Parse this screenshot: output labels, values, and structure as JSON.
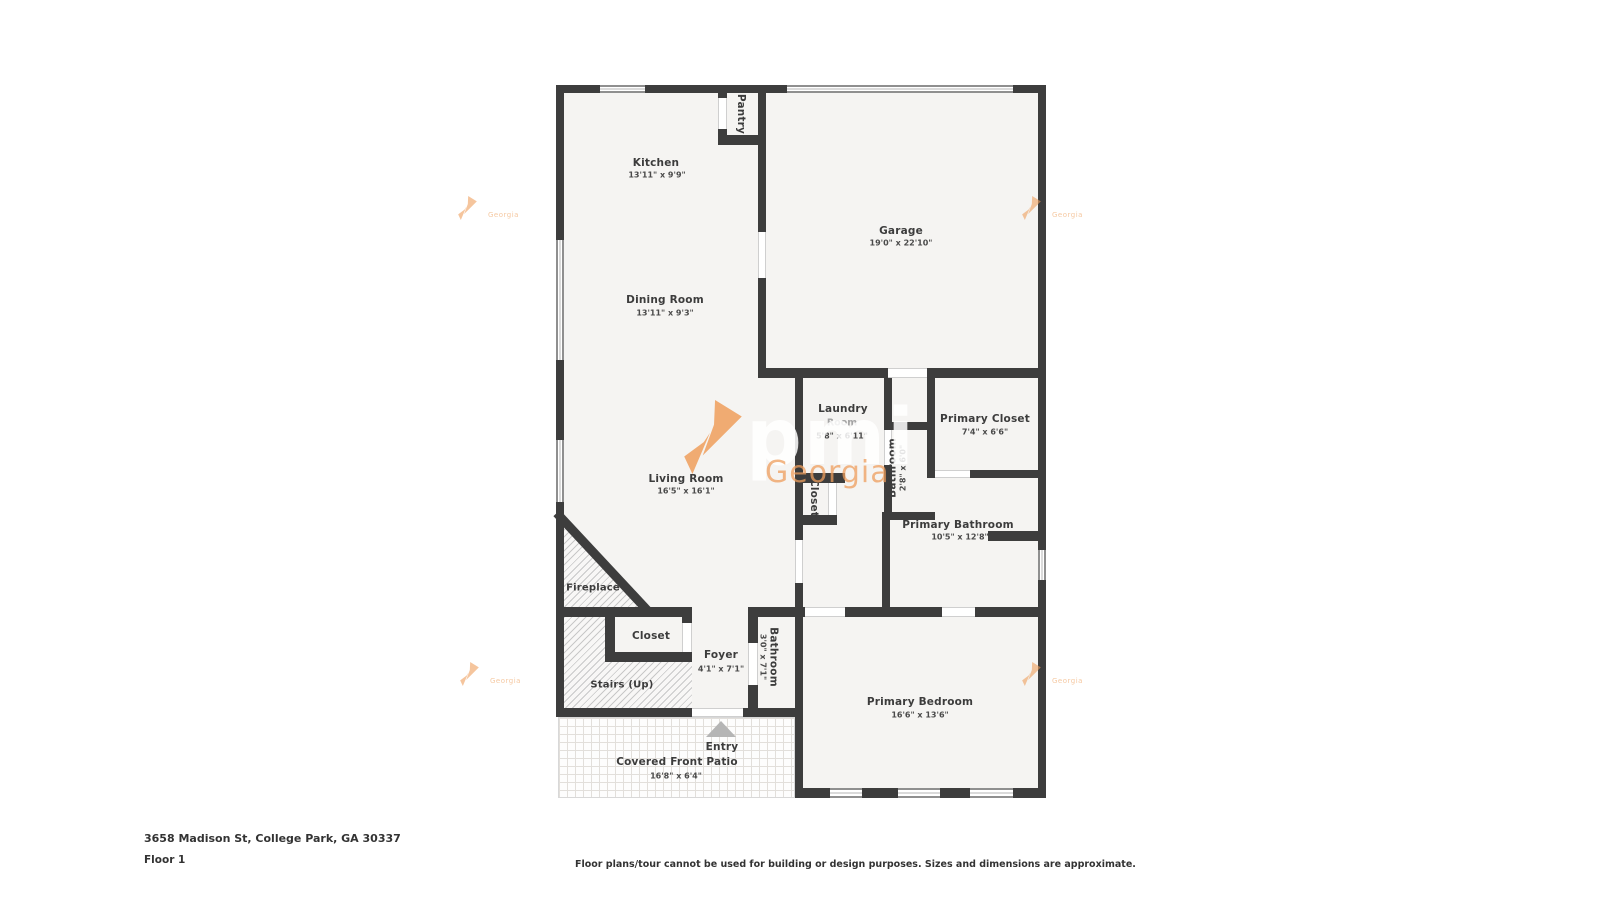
{
  "palette": {
    "wall": "#3d3d3d",
    "floor": "#f5f4f2",
    "accent_orange": "#ee9e5c",
    "label": "#3c3c3c",
    "muted_label": "#a3a3a3",
    "arrow_gray": "#b5b5b5"
  },
  "rooms": {
    "kitchen": {
      "label": "Kitchen",
      "dims": "13'11\" x 9'9\""
    },
    "pantry": {
      "label": "Pantry"
    },
    "garage": {
      "label": "Garage",
      "dims": "19'0\" x 22'10\""
    },
    "dining": {
      "label": "Dining Room",
      "dims": "13'11\" x 9'3\""
    },
    "living": {
      "label": "Living Room",
      "dims": "16'5\" x 16'1\""
    },
    "laundry": {
      "label": "Laundry",
      "label2": "Room",
      "dims": "5'8\" x 6'11\""
    },
    "bathroom_small": {
      "label": "Bathroom",
      "dims": "2'8\" x 6'0\""
    },
    "primary_closet": {
      "label": "Primary Closet",
      "dims": "7'4\" x 6'6\""
    },
    "hall_closet": {
      "label": "Closet"
    },
    "primary_bathroom": {
      "label": "Primary Bathroom",
      "dims": "10'5\" x 12'8\""
    },
    "fireplace": {
      "label": "Fireplace"
    },
    "foyer_closet": {
      "label": "Closet"
    },
    "foyer": {
      "label": "Foyer",
      "dims": "4'1\" x 7'1\""
    },
    "foyer_bathroom": {
      "label": "Bathroom",
      "dims": "3'0\" x 7'1\""
    },
    "stairs": {
      "label": "Stairs (Up)"
    },
    "primary_bedroom": {
      "label": "Primary Bedroom",
      "dims": "16'6\" x 13'6\""
    },
    "entry": {
      "label": "Entry"
    },
    "patio": {
      "label": "Covered Front Patio",
      "dims": "16'8\" x 6'4\""
    }
  },
  "watermark": {
    "brand": "pmi",
    "region": "Georgia"
  },
  "footer": {
    "address": "3658 Madison St, College Park, GA 30337",
    "floor": "Floor 1",
    "disclaimer": "Floor plans/tour cannot be used for building or design purposes. Sizes and dimensions are approximate."
  }
}
